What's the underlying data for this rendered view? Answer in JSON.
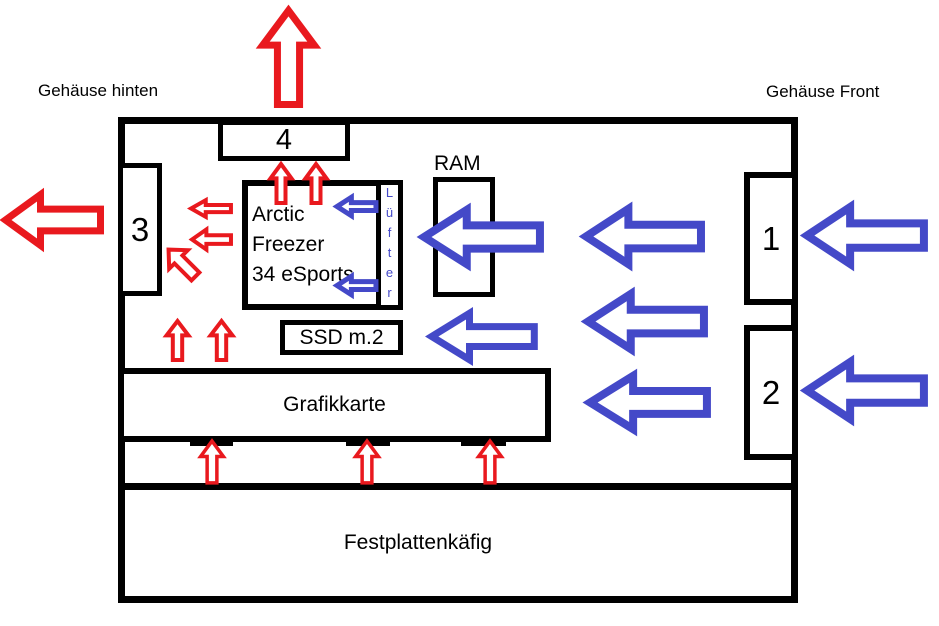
{
  "colors": {
    "exhaust_red": "#e9191e",
    "intake_blue": "#4449c8",
    "outline": "#000000",
    "background": "#ffffff"
  },
  "labels": {
    "case_rear": "Gehäuse hinten",
    "case_front": "Gehäuse Front",
    "ram": "RAM"
  },
  "components": {
    "fan_top": "4",
    "fan_rear": "3",
    "fan_front_upper": "1",
    "fan_front_lower": "2",
    "cpu_cooler_line1": "Arctic Freezer",
    "cpu_cooler_line2": "34 eSports",
    "cpu_cooler_fan": "Lüfter",
    "ssd": "SSD m.2",
    "gpu": "Grafikkarte",
    "hdd_cage": "Festplattenkäfig"
  }
}
